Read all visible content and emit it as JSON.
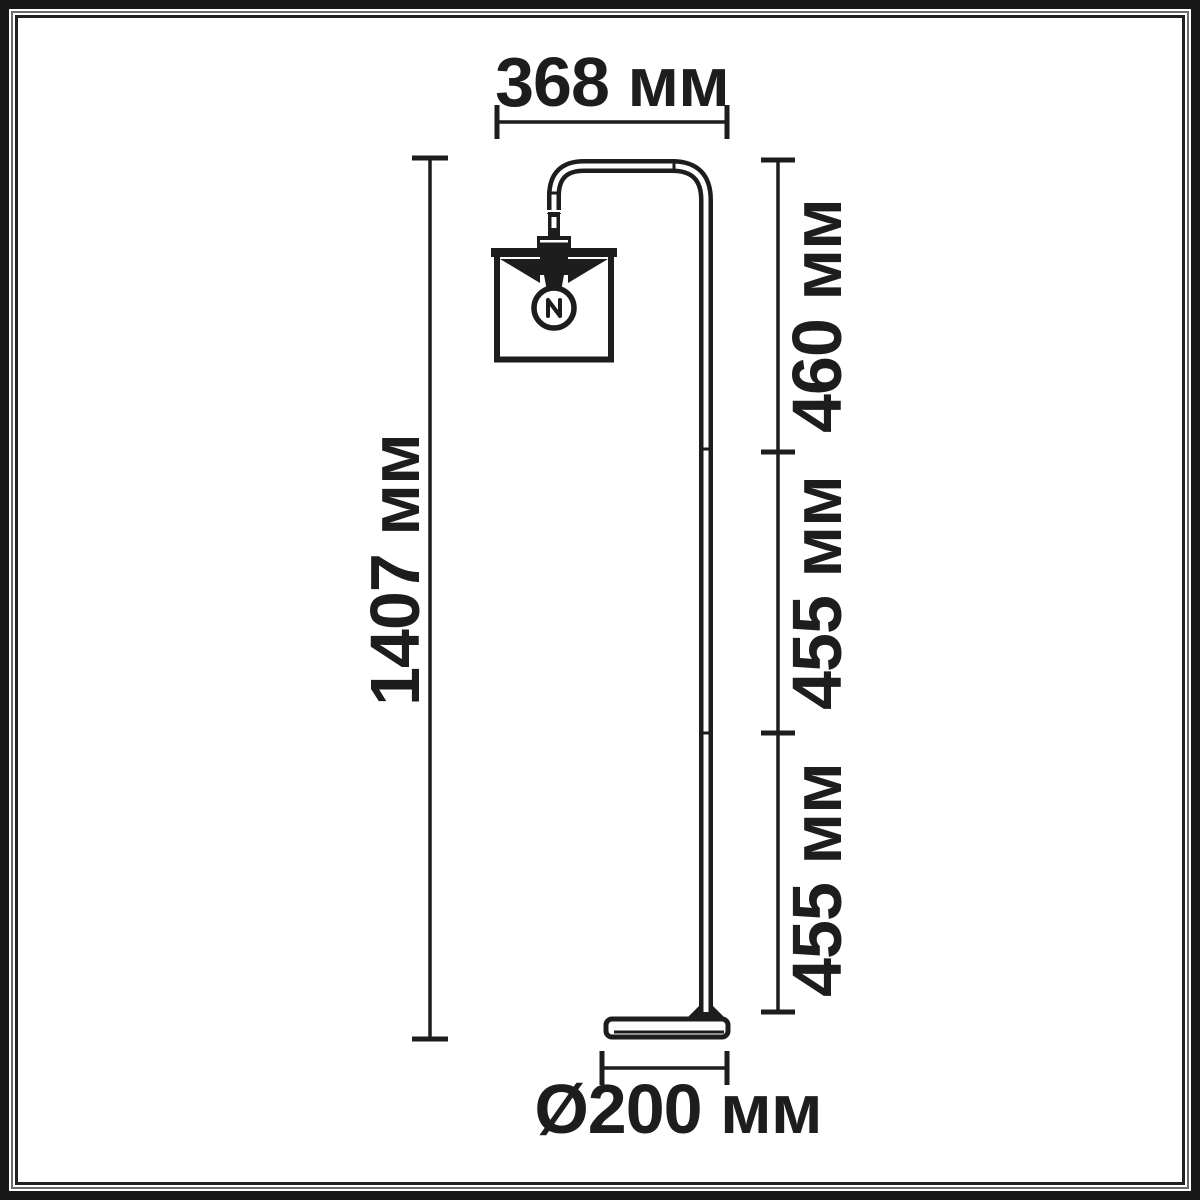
{
  "frame": {
    "outer_border_color": "#181818",
    "inner_border_color": "#222222",
    "ink_color": "#1d1d1d",
    "background_color": "#ffffff"
  },
  "diagram": {
    "labels": {
      "arm_width": "368 мм",
      "total_height": "1407 мм",
      "upper_segment": "460 мм",
      "middle_segment": "455 мм",
      "lower_segment": "455 мм",
      "base_diameter": "Ø200 мм"
    }
  }
}
